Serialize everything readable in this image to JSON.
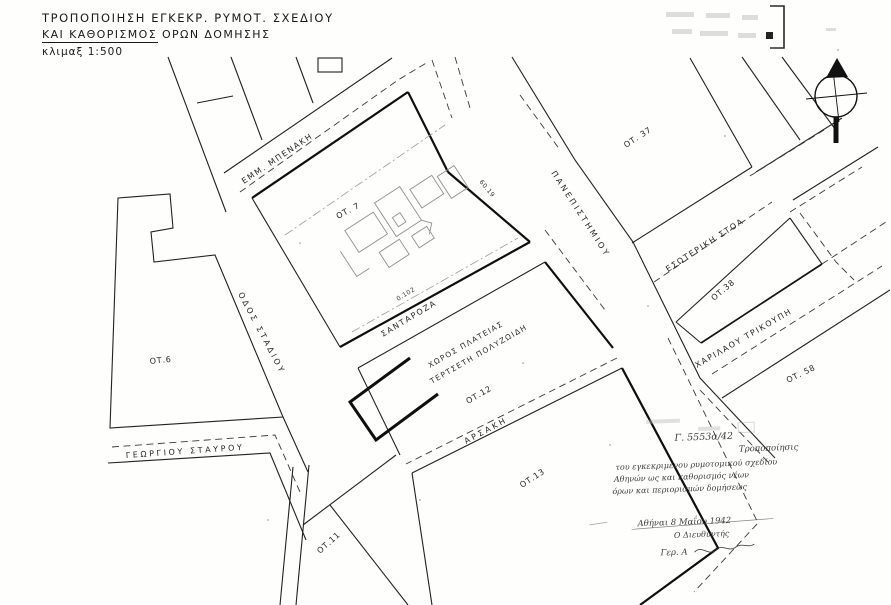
{
  "title": {
    "line1": "ΤΡΟΠΟΠΟΙΗΣΗ  ΕΓΚΕΚΡ. ΡΥΜΟΤ. ΣΧΕΔΙΟΥ",
    "line2": "ΚΑΙ  ΚΑΘΟΡΙΣΜΟΣ  ΟΡΩΝ  ΔΟΜΗΣΗΣ",
    "scale": "κλιμαξ 1:500"
  },
  "streets": {
    "emm_benaki": "ΕΜΜ. ΜΠΕΝΑΚΗ",
    "stadiou": "ΟΔΟΣ ΣΤΑΔΙΟΥ",
    "panepistimiou": "ΠΑΝΕΠΙΣΤΗΜΙΟΥ",
    "santaroza": "ΣΑΝΤΑΡΟΖΑ",
    "arsaki": "ΑΡΣΑΚΗ",
    "georgiou_stavrou": "ΓΕΩΡΓΙΟΥ ΣΤΑΥΡΟΥ",
    "esoteriki_stoa": "ΕΣΩΤΕΡΙΚΗ ΣΤΟΑ",
    "charilaou_trikoupi": "ΧΑΡΙΛΑΟΥ ΤΡΙΚΟΥΠΗ"
  },
  "blocks": {
    "ot6": "ΟΤ.6",
    "ot7": "ΟΤ. 7",
    "ot11": "ΟΤ.11",
    "ot12": "ΟΤ.12",
    "ot13": "ΟΤ.13",
    "ot37": "ΟΤ. 37",
    "ot38": "ΟΤ.38",
    "ot58": "ΟΤ. 58"
  },
  "square": {
    "line1": "ΧΩΡΟΣ  ΠΛΑΤΕΙΑΣ",
    "line2": "ΤΕΡΤΣΕΤΗ  ΠΟΛΥΖΩΙΔΗ"
  },
  "dimensions": {
    "d1": "60.19",
    "d2": "0.102"
  },
  "handwriting": {
    "decree": "Γ. 5553α/42",
    "line1": "Τροποποίησις",
    "line2": "του εγκεκριμένου ρυμοτομικού σχεδίου",
    "line3": "Αθηνών ως και καθορισμός νέων",
    "line4": "όρων και περιορισμών δομήσεως",
    "date": "Αθήναι 8 Μαΐου 1942",
    "role": "Ο Διευθυντής",
    "signature": "Γερ. Α"
  },
  "colors": {
    "ink": "#1a1a1a",
    "faint": "#9b9b9b",
    "paper": "#fefefd"
  }
}
